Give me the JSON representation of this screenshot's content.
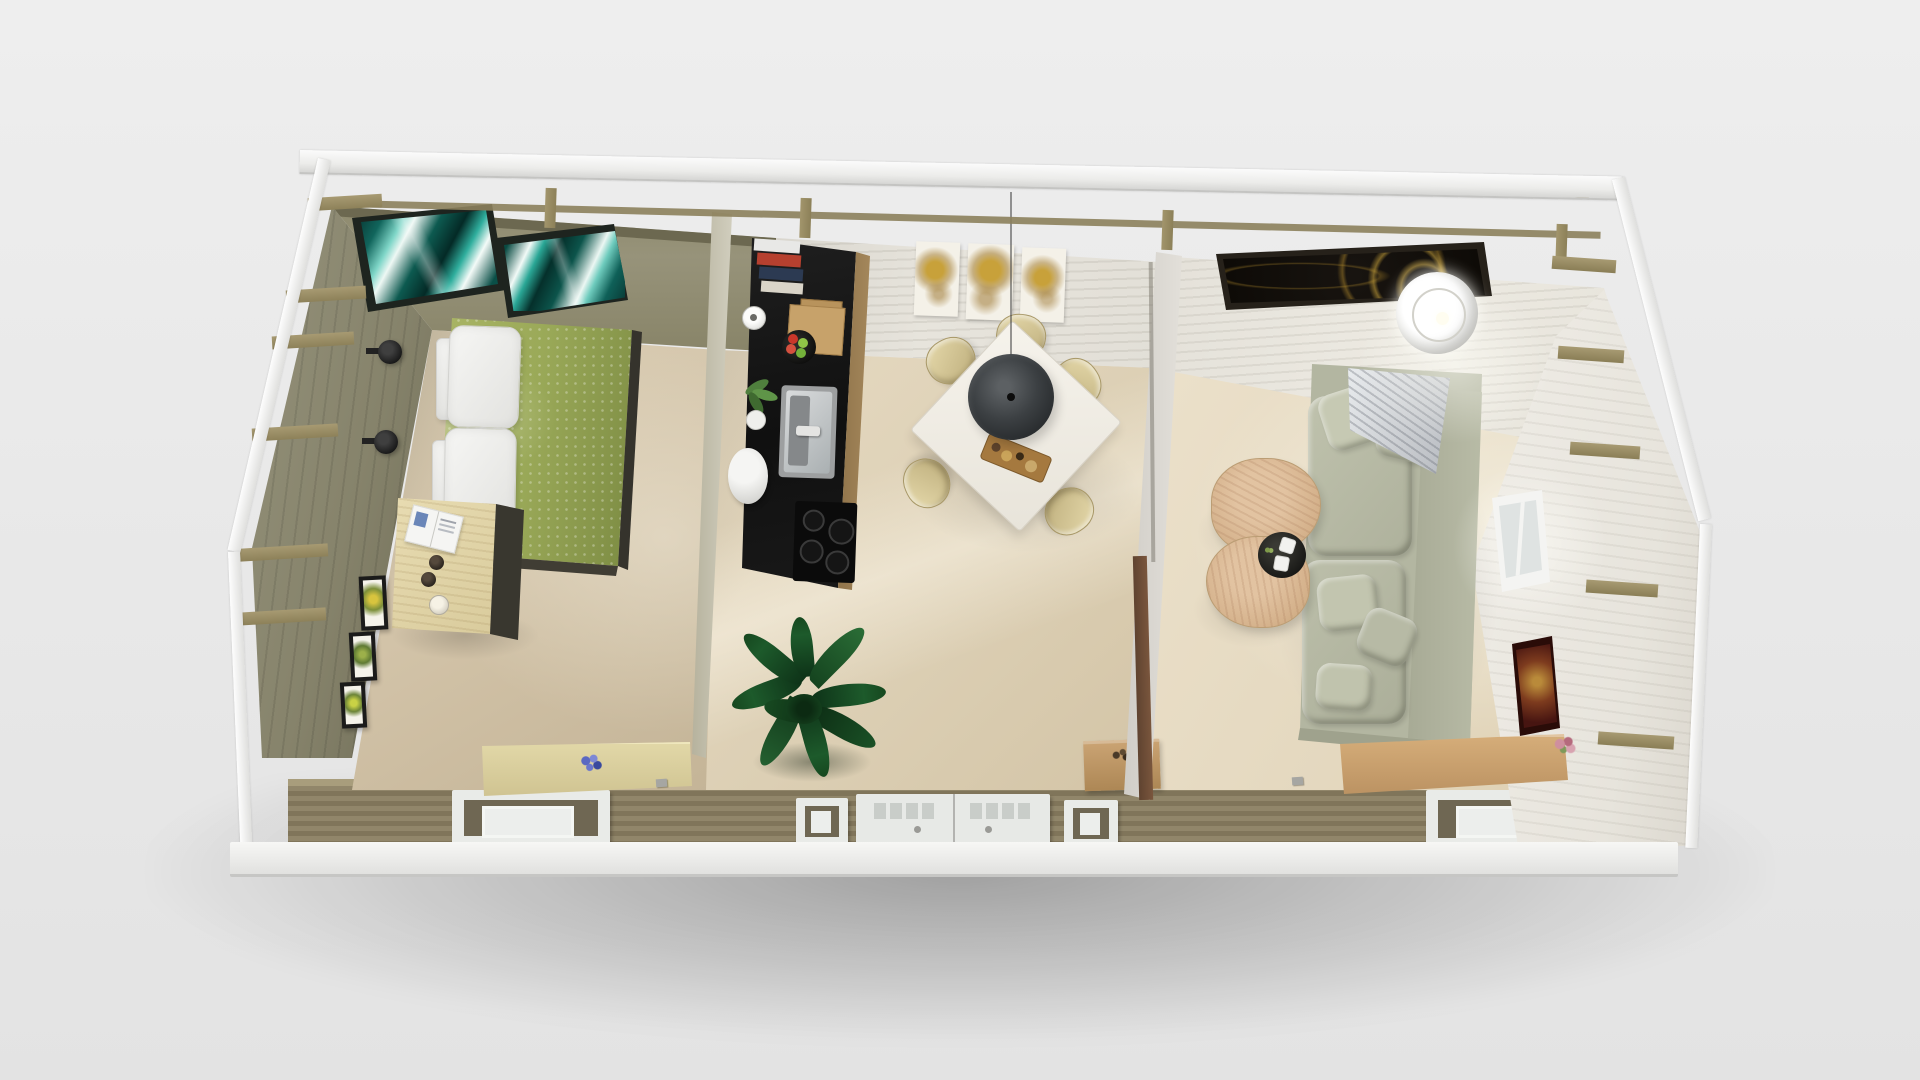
{
  "scene": {
    "title": "Top-down 3D rendering of a three-room garden cabin interior (roof removed)",
    "view": "bird's-eye perspective",
    "background_color": "#e9e9e9",
    "ground_shadow_color": "#b5b5b5"
  },
  "building": {
    "fascia_rail_color": "#f3f3f1",
    "rafter_color": "#9c8f66",
    "exterior_siding_color": "#8a7f60",
    "base_rail_color": "#f0f0ee",
    "openings_bottom_wall": [
      "bedroom window",
      "narrow window",
      "double glazed entrance door",
      "narrow window",
      "living room window"
    ],
    "right_wall_openings": [
      "small window"
    ]
  },
  "rooms": [
    {
      "name": "Bedroom",
      "position": "left",
      "wall_color": "#8e8b70",
      "floor_color": "#d6c8ae",
      "furniture": [
        "two teal abstract framed artworks on top wall",
        "double bed with green dotted duvet and white pillows",
        "two black wall-mounted reading lamps",
        "light wood nightstand desk with open magazine, two cups and a candle",
        "three framed botanical prints on left wall",
        "light wood bench with blue flowers against bottom wall"
      ]
    },
    {
      "name": "Kitchen / Dining",
      "position": "center",
      "wall_color": "#e5e2da",
      "floor_color": "#dfd2ba",
      "furniture": [
        "black kitchenette counter with book shelf, cutting boards, white vase, fruit bowl, herb pot, stainless sink and cooktop",
        "white square dining table",
        "five light wood chairs",
        "black cone pendant lamp on cord",
        "serving board with food",
        "triptych of gold flower paintings on top wall",
        "large dark green potted plant",
        "small wooden stool with twigs"
      ]
    },
    {
      "name": "Living Room",
      "position": "right",
      "wall_color": "#edebe5",
      "floor_color": "#e9dfc9",
      "furniture": [
        "wide black artwork with gold rose on top wall",
        "sage green fabric sofa with cushions and gray striped throw",
        "two round pinkish-wood coffee tables",
        "black round tray with two white cups and a sprig",
        "white drum floor lamp seen from above",
        "window in right wall",
        "small dark red framed picture on right wall",
        "light wood sideboard with pink flowers against bottom wall"
      ]
    }
  ],
  "palette": {
    "bed_duvet_green": "#9fae5a",
    "teal_art": [
      "#0a4a44",
      "#35b3a5",
      "#eef8f4"
    ],
    "counter_black": "#161616",
    "pendant_gray": "#3c4043",
    "chair_wood": "#d2c498",
    "sofa_sage": "#b5b8a3",
    "coffee_table_wood": "#dbb695",
    "gold_art": [
      "#0d0a06",
      "#c9a33c"
    ],
    "siding_olive": "#8a7f60"
  }
}
